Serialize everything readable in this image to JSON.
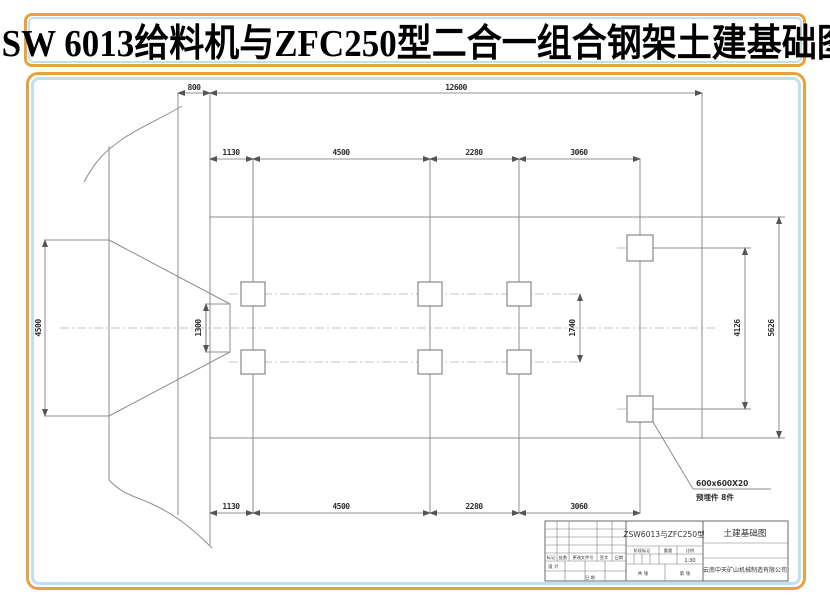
{
  "page_title": "ZSW 6013给料机与ZFC250型二合一组合钢架土建基础图",
  "dims": {
    "d800": "800",
    "d12600": "12600",
    "d1130": "1130",
    "d4500_col": "4500",
    "d2280": "2280",
    "d3060": "3060",
    "d4500_left": "4500",
    "d1300": "1300",
    "d1740": "1740",
    "d4126": "4126",
    "d5626": "5626"
  },
  "annotation": {
    "line1": "600x600X20",
    "line2": "预埋件  8件"
  },
  "title_block": {
    "model": "ZSW6013与ZFC250型",
    "sheet_title": "土建基础图",
    "company": "云南中天矿山机械制造有限公司",
    "stage_label": "阶段标记",
    "weight_label": "重量",
    "scale_label": "比例",
    "scale_value": "1:30",
    "sheet_total": "共  张",
    "sheet_no": "第  张",
    "rev_mark": "标记",
    "rev_count": "处数",
    "rev_file": "更改文件号",
    "rev_sign": "签字",
    "rev_date": "日期",
    "design_label": "设 计",
    "date_label": "日 期"
  },
  "colors": {
    "accent_orange": "#E7A33B",
    "accent_blue": "#BFE0F2",
    "line_gray": "#8c8c8c"
  }
}
